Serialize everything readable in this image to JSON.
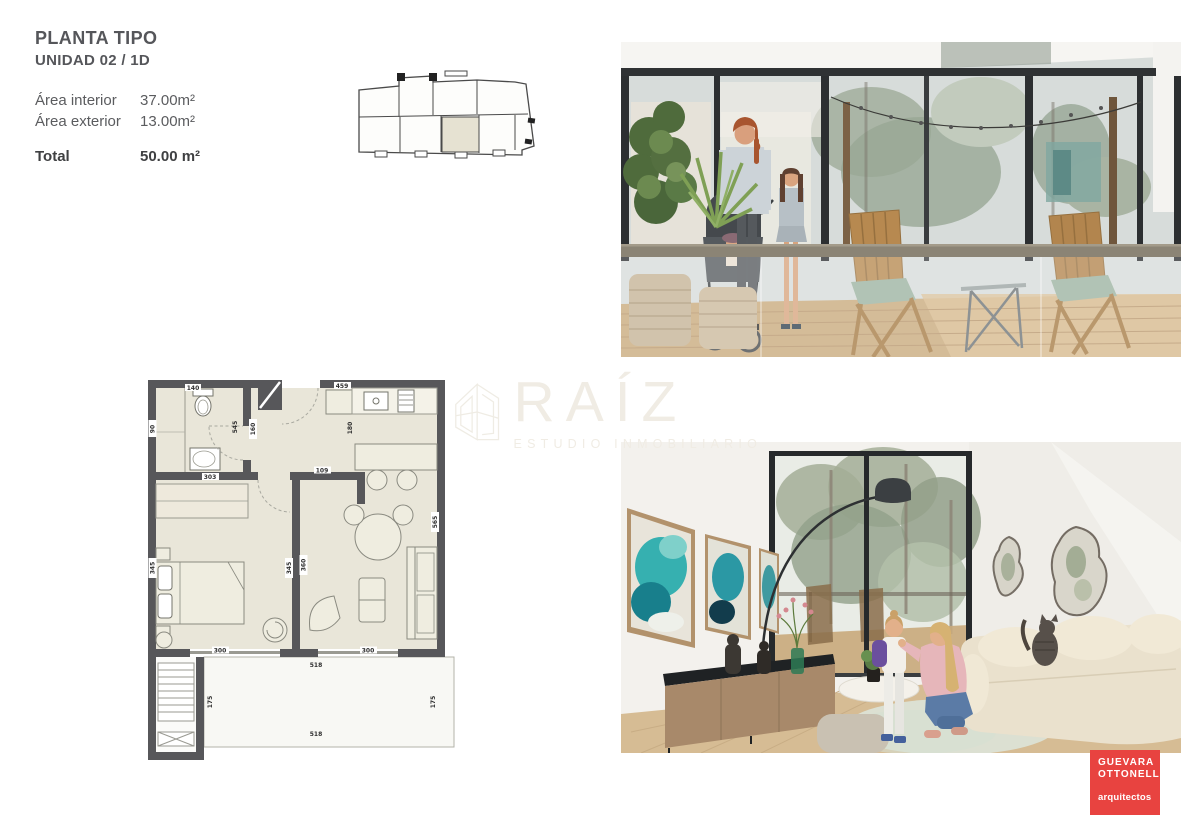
{
  "header": {
    "title": "PLANTA TIPO",
    "subtitle": "UNIDAD 02 / 1D"
  },
  "areas": {
    "interior_label": "Área interior",
    "interior_value": "37.00m²",
    "exterior_label": "Área exterior",
    "exterior_value": "13.00m²",
    "total_label": "Total",
    "total_value": "50.00 m²"
  },
  "floorplan": {
    "dims": {
      "kitchen_width": "459",
      "toilet": "140",
      "bath_height": "545",
      "hall": "160",
      "kitchen_depth": "180",
      "hall_door": "109",
      "bedroom_width": "303",
      "living_height": "565",
      "bedroom_left": "345",
      "divider_west": "345",
      "divider_east": "360",
      "bedroom_bottom": "300",
      "living_bottom": "300",
      "terrace_top": "518",
      "terrace_bottom": "518",
      "terrace_left": "175",
      "terrace_right": "175",
      "shower": "90"
    }
  },
  "watermark": {
    "brand": "RAÍZ",
    "tagline": "ESTUDIO INMOBILIARIO"
  },
  "logo": {
    "line1": "GUEVARA",
    "line2": "OTTONELLO",
    "sub": "arquitectos"
  },
  "colors": {
    "accent_red": "#e84340",
    "plan_wall": "#57575a",
    "plan_floor": "#e9e6d9"
  }
}
